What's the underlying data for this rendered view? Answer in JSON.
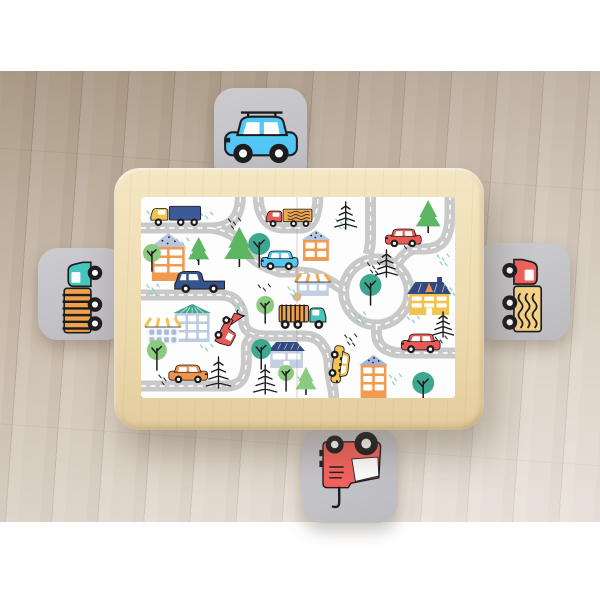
{
  "meta": {
    "type": "product-photo",
    "subject": "Kids wooden play table with city road play-mat top and four grey stools with vehicle decals on a light wood plank floor",
    "canvas_w": 600,
    "canvas_h": 600
  },
  "palette": {
    "wall": "#ffffff",
    "floor_base": "#cdbfae",
    "wood": "#eedcb0",
    "stool_grey": "#c6c5c9",
    "ink": "#1d1d1f",
    "road": "#c9c9ca",
    "dash": "#ffffff",
    "red": "#ea5a54",
    "orange": "#f0944d",
    "yellow": "#f2c34e",
    "navy": "#35538d",
    "lightblue": "#52c6f4",
    "teal": "#47c6be",
    "tree_teal": "#3ea78f",
    "tree_green": "#8ccb7f",
    "pine_green": "#5db762",
    "roof_blue": "#b7c6dd",
    "roof_navy": "#31497e",
    "knob_wood": "#d8ba8e"
  },
  "floor": {
    "top": 71,
    "bottom": 522,
    "tilt_deg": 4,
    "plank_w": 46
  },
  "table": {
    "x": 114,
    "y": 168,
    "w": 370,
    "h": 262,
    "radius": 26,
    "mat": {
      "x": 27,
      "y": 29,
      "w": 314,
      "h": 201,
      "seam_x": 157,
      "knob_y": 100
    }
  },
  "stools": [
    {
      "id": "top",
      "x": 214,
      "y": 88,
      "w": 93,
      "h": 96,
      "decal": {
        "kind": "car",
        "body": "#52c6f4",
        "dir": "left",
        "rack": true,
        "rot": 0,
        "w": 78,
        "h": 50
      }
    },
    {
      "id": "left",
      "x": 38,
      "y": 248,
      "w": 88,
      "h": 92,
      "decal": {
        "kind": "logtruck",
        "cab": "#47c6be",
        "box": "#f0a14c",
        "dir": "right",
        "rot": -90,
        "w": 80,
        "h": 46
      }
    },
    {
      "id": "right",
      "x": 476,
      "y": 243,
      "w": 94,
      "h": 97,
      "decal": {
        "kind": "loadtruck",
        "cab": "#ef625c",
        "box": "#f5d287",
        "dir": "left",
        "rot": 90,
        "w": 80,
        "h": 46
      }
    },
    {
      "id": "bottom",
      "x": 302,
      "y": 428,
      "w": 96,
      "h": 95,
      "decal": {
        "kind": "towtruck180",
        "body": "#f4625e",
        "rot": 0,
        "w": 78,
        "h": 78
      }
    }
  ],
  "mat_scene": {
    "road_w": 11,
    "roads": [
      "M0,31 H70 Q88,31 95,20 Q100,12 100,0",
      "M118,0 Q118,14 125,23 Q132,31 144,31 H160 Q170,31 174,22 Q178,13 178,0",
      "M70,31 Q92,34 100,46 Q106,57 116,64 Q126,71 140,75 H156 Q174,75 186,82 Q198,89 206,94",
      "M231,0 V40 Q231,52 228,58",
      "M254,73 Q262,57 274,52 H284 Q300,52 306,42 Q311,33 311,16 V0",
      "M237,128 V136 Q237,148 248,153 Q254,156 264,156 H316",
      "M0,98 H78 Q94,98 99,108 Q103,115 103,123 Q103,132 111,136 Q117,139 126,139 H164 Q176,139 182,147 Q188,155 189,163 Q190,177 192,187 Q194,196 194,201",
      "M0,189 H86 Q99,189 103,180 Q106,173 106,164 V152 Q106,143 114,139"
    ],
    "roundabout": {
      "cx": 237,
      "cy": 95,
      "r": 33
    },
    "houses": [
      {
        "x": 11,
        "y": 36,
        "w": 33,
        "h": 48,
        "rh": 14,
        "style": "tri-dot",
        "body": "#f09a52",
        "roof": "#b7c6dd",
        "wc": 2,
        "wr": 3
      },
      {
        "x": 163,
        "y": 33,
        "w": 26,
        "h": 31,
        "rh": 10,
        "style": "tri-dot",
        "body": "#f09a52",
        "roof": "#b7c6dd",
        "wc": 2,
        "wr": 2
      },
      {
        "x": 157,
        "y": 77,
        "w": 32,
        "h": 22,
        "rh": 8,
        "style": "awning",
        "body": "#c3d0e2",
        "roof": "#f0a94f",
        "wc": 3,
        "wr": 1,
        "win": "#ffffff"
      },
      {
        "x": 34,
        "y": 107,
        "w": 35,
        "h": 38,
        "rh": 9,
        "style": "tri-stripe",
        "body": "#bccbdf",
        "roof": "#3ea78f",
        "wc": 3,
        "wr": 3
      },
      {
        "x": 6,
        "y": 121,
        "w": 32,
        "h": 26,
        "rh": 9,
        "style": "awning",
        "body": "#f4f6fa",
        "roof": "#f2c34e",
        "wc": 4,
        "wr": 2,
        "win": "#a9bcd6"
      },
      {
        "x": 130,
        "y": 145,
        "w": 33,
        "h": 26,
        "rh": 9,
        "style": "navy",
        "body": "#c3d0e2",
        "roof": "#31497e",
        "wc": 2,
        "wr": 1,
        "door": true
      },
      {
        "x": 270,
        "y": 85,
        "w": 40,
        "h": 33,
        "rh": 12,
        "style": "hatch",
        "body": "#f2c34e",
        "roof": "#31497e",
        "wc": 3,
        "wr": 2,
        "door": true,
        "chimney": true,
        "warn": true
      },
      {
        "x": 221,
        "y": 158,
        "w": 26,
        "h": 43,
        "rh": 10,
        "style": "tri-dot",
        "body": "#f09a52",
        "roof": "#9fb6d8",
        "wc": 2,
        "wr": 3
      }
    ],
    "trees": [
      {
        "t": "pine",
        "cx": 58,
        "y": 40,
        "h": 28,
        "c": "#5db762"
      },
      {
        "t": "pine",
        "cx": 99,
        "y": 30,
        "h": 40,
        "c": "#5db762"
      },
      {
        "t": "round",
        "cx": 119,
        "cy": 47,
        "r": 11,
        "c": "#3ea78f",
        "base": 70
      },
      {
        "t": "round",
        "cx": 11,
        "cy": 56,
        "r": 9,
        "c": "#8ccb7f",
        "base": 74
      },
      {
        "t": "sketch",
        "cx": 206,
        "y": 2,
        "h": 30
      },
      {
        "t": "pine",
        "cx": 289,
        "y": 3,
        "h": 33,
        "c": "#5db762"
      },
      {
        "t": "round",
        "cx": 231,
        "cy": 88,
        "r": 11,
        "c": "#3ea78f",
        "base": 108
      },
      {
        "t": "sketch",
        "cx": 247,
        "y": 50,
        "h": 30
      },
      {
        "t": "sketch",
        "cx": 304,
        "y": 112,
        "h": 28
      },
      {
        "t": "round",
        "cx": 121,
        "cy": 152,
        "r": 10,
        "c": "#3ea78f",
        "base": 172
      },
      {
        "t": "round",
        "cx": 16,
        "cy": 153,
        "r": 10,
        "c": "#8ccb7f",
        "base": 173
      },
      {
        "t": "round",
        "cx": 125,
        "cy": 108,
        "r": 9,
        "c": "#8ccb7f",
        "base": 126
      },
      {
        "t": "sketch",
        "cx": 78,
        "y": 157,
        "h": 34
      },
      {
        "t": "sketch",
        "cx": 125,
        "y": 165,
        "h": 32
      },
      {
        "t": "round",
        "cx": 146,
        "cy": 176,
        "r": 8,
        "c": "#8ccb7f",
        "base": 194
      },
      {
        "t": "pine",
        "cx": 166,
        "y": 170,
        "h": 28,
        "c": "#8ccb7f"
      },
      {
        "t": "round",
        "cx": 284,
        "cy": 186,
        "r": 11,
        "c": "#3ea78f",
        "base": 201
      }
    ],
    "vehicles": [
      {
        "kind": "truck",
        "x": 10,
        "y": 8,
        "w": 50,
        "h": 21,
        "dir": "left",
        "cab": "#f2c34e",
        "box": "#3d5a96"
      },
      {
        "kind": "loadtruck",
        "x": 126,
        "y": 11,
        "w": 46,
        "h": 19,
        "dir": "left",
        "cab": "#ea5a54",
        "box": "#f0a94f"
      },
      {
        "kind": "car",
        "x": 121,
        "y": 54,
        "w": 37,
        "h": 19,
        "dir": "left",
        "body": "#52c6f4"
      },
      {
        "kind": "car",
        "x": 246,
        "y": 32,
        "w": 36,
        "h": 18,
        "dir": "left",
        "body": "#ea5a54"
      },
      {
        "kind": "pickup",
        "x": 34,
        "y": 74,
        "w": 50,
        "h": 22,
        "dir": "left",
        "body": "#35538d"
      },
      {
        "kind": "towtruck",
        "x": 70,
        "y": 120,
        "w": 38,
        "h": 20,
        "dir": "right",
        "body": "#ea5a54",
        "rot": 118
      },
      {
        "kind": "logtruck",
        "x": 139,
        "y": 107,
        "w": 47,
        "h": 25,
        "dir": "right",
        "cab": "#47c6be",
        "box": "#f0a14c"
      },
      {
        "kind": "taxi",
        "x": 181,
        "y": 158,
        "w": 37,
        "h": 19,
        "dir": "right",
        "body": "#f2c34e",
        "rot": 97
      },
      {
        "kind": "car",
        "x": 262,
        "y": 137,
        "w": 39,
        "h": 19,
        "dir": "left",
        "body": "#ea5a54"
      },
      {
        "kind": "car",
        "x": 28,
        "y": 168,
        "w": 39,
        "h": 18,
        "dir": "right",
        "body": "#f0944d"
      }
    ],
    "scatter": [
      [
        60,
        16,
        "t"
      ],
      [
        88,
        22,
        "k"
      ],
      [
        196,
        22,
        "t"
      ],
      [
        282,
        20,
        "t"
      ],
      [
        262,
        42,
        "k"
      ],
      [
        6,
        88,
        "t"
      ],
      [
        50,
        58,
        "k"
      ],
      [
        148,
        90,
        "t"
      ],
      [
        214,
        116,
        "t"
      ],
      [
        296,
        140,
        "k"
      ],
      [
        250,
        178,
        "t"
      ],
      [
        158,
        180,
        "t"
      ],
      [
        60,
        148,
        "t"
      ],
      [
        18,
        178,
        "k"
      ],
      [
        228,
        66,
        "k"
      ],
      [
        118,
        88,
        "k"
      ],
      [
        36,
        42,
        "t"
      ],
      [
        298,
        58,
        "t"
      ],
      [
        268,
        120,
        "t"
      ],
      [
        92,
        106,
        "t"
      ],
      [
        205,
        138,
        "k"
      ],
      [
        176,
        44,
        "t"
      ],
      [
        6,
        14,
        "t"
      ],
      [
        306,
        88,
        "t"
      ]
    ],
    "scatter_colors": {
      "t": "#7fcbbd",
      "k": "#2b2b2e"
    }
  }
}
